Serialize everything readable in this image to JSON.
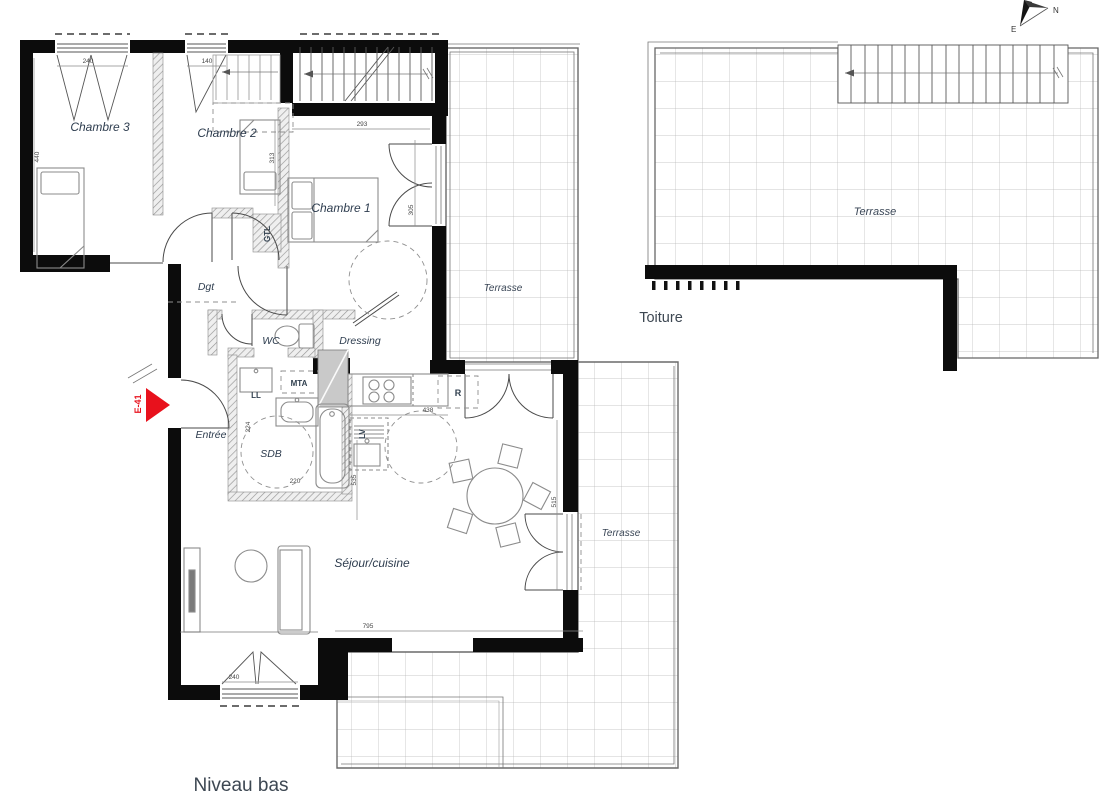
{
  "plan": {
    "level_label": "Niveau bas",
    "roof_label": "Toiture",
    "entry_tag": "E-41",
    "compass": {
      "north": "N",
      "east": "E"
    },
    "rooms": {
      "chambre1": "Chambre 1",
      "chambre2": "Chambre 2",
      "chambre3": "Chambre 3",
      "dgt": "Dgt",
      "wc": "WC",
      "dressing": "Dressing",
      "entree": "Entrée",
      "sdb": "SDB",
      "sejour": "Séjour/cuisine",
      "terrasse_upper": "Terrasse",
      "terrasse_lower": "Terrasse",
      "terrasse_roof": "Terrasse"
    },
    "equipment": {
      "gtl": "GTL",
      "mta": "MTA",
      "ll": "LL",
      "lv": "LV",
      "fridge": "R"
    },
    "dimensions": {
      "chambre3_window": "240",
      "chambre2_window": "140",
      "chambre3_height": "440",
      "chambre1_width": "293",
      "chambre2_depth": "313",
      "chambre1_door": "305",
      "sdb_depth": "224",
      "sdb_width": "220",
      "sejour_left": "535",
      "sejour_right": "515",
      "kitchen": "438",
      "sejour_width": "795",
      "sejour_window": "240"
    },
    "colors": {
      "wall": "#0c0c0c",
      "accent_red": "#e8111c",
      "label": "#2e3d4f"
    }
  }
}
